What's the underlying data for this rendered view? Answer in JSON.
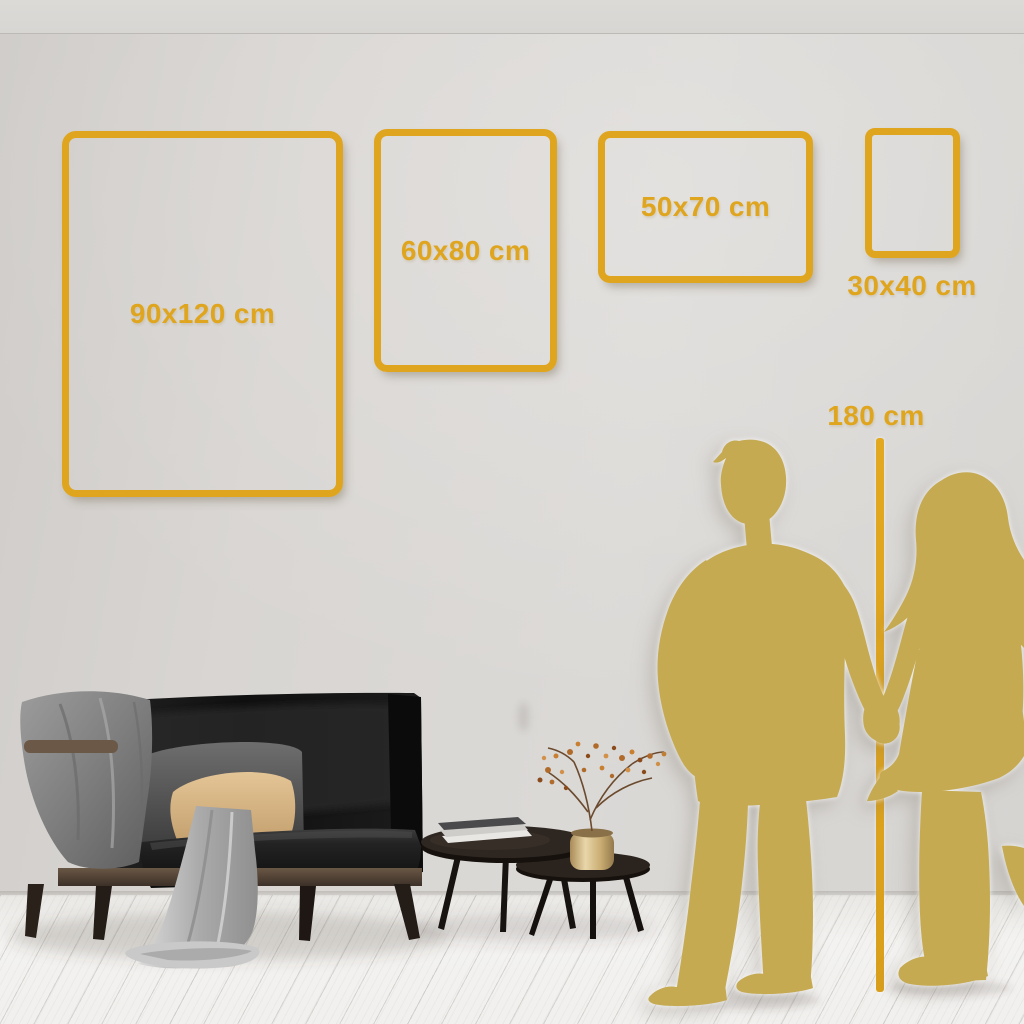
{
  "size_guide": {
    "frames": [
      {
        "id": "90x120",
        "label": "90x120 cm",
        "width_cm": 90,
        "height_cm": 120,
        "orientation": "portrait"
      },
      {
        "id": "60x80",
        "label": "60x80 cm",
        "width_cm": 60,
        "height_cm": 80,
        "orientation": "portrait"
      },
      {
        "id": "50x70",
        "label": "50x70 cm",
        "width_cm": 50,
        "height_cm": 70,
        "orientation": "landscape"
      },
      {
        "id": "30x40",
        "label": "30x40 cm",
        "width_cm": 30,
        "height_cm": 40,
        "orientation": "portrait"
      }
    ],
    "height_marker": {
      "label": "180 cm",
      "height_cm": 180
    }
  },
  "palette": {
    "gold_accent": "#DFA51E",
    "silhouette_gold": "#C5AA52",
    "wall_gray": "#D7D4D1",
    "floor_white": "#F1F0EE",
    "sofa_black": "#161616",
    "pillow_beige": "#D9B787",
    "blanket_gray": "#8F8F8F",
    "wood_brown": "#5A4836",
    "vase_gold": "#C9AC72"
  }
}
